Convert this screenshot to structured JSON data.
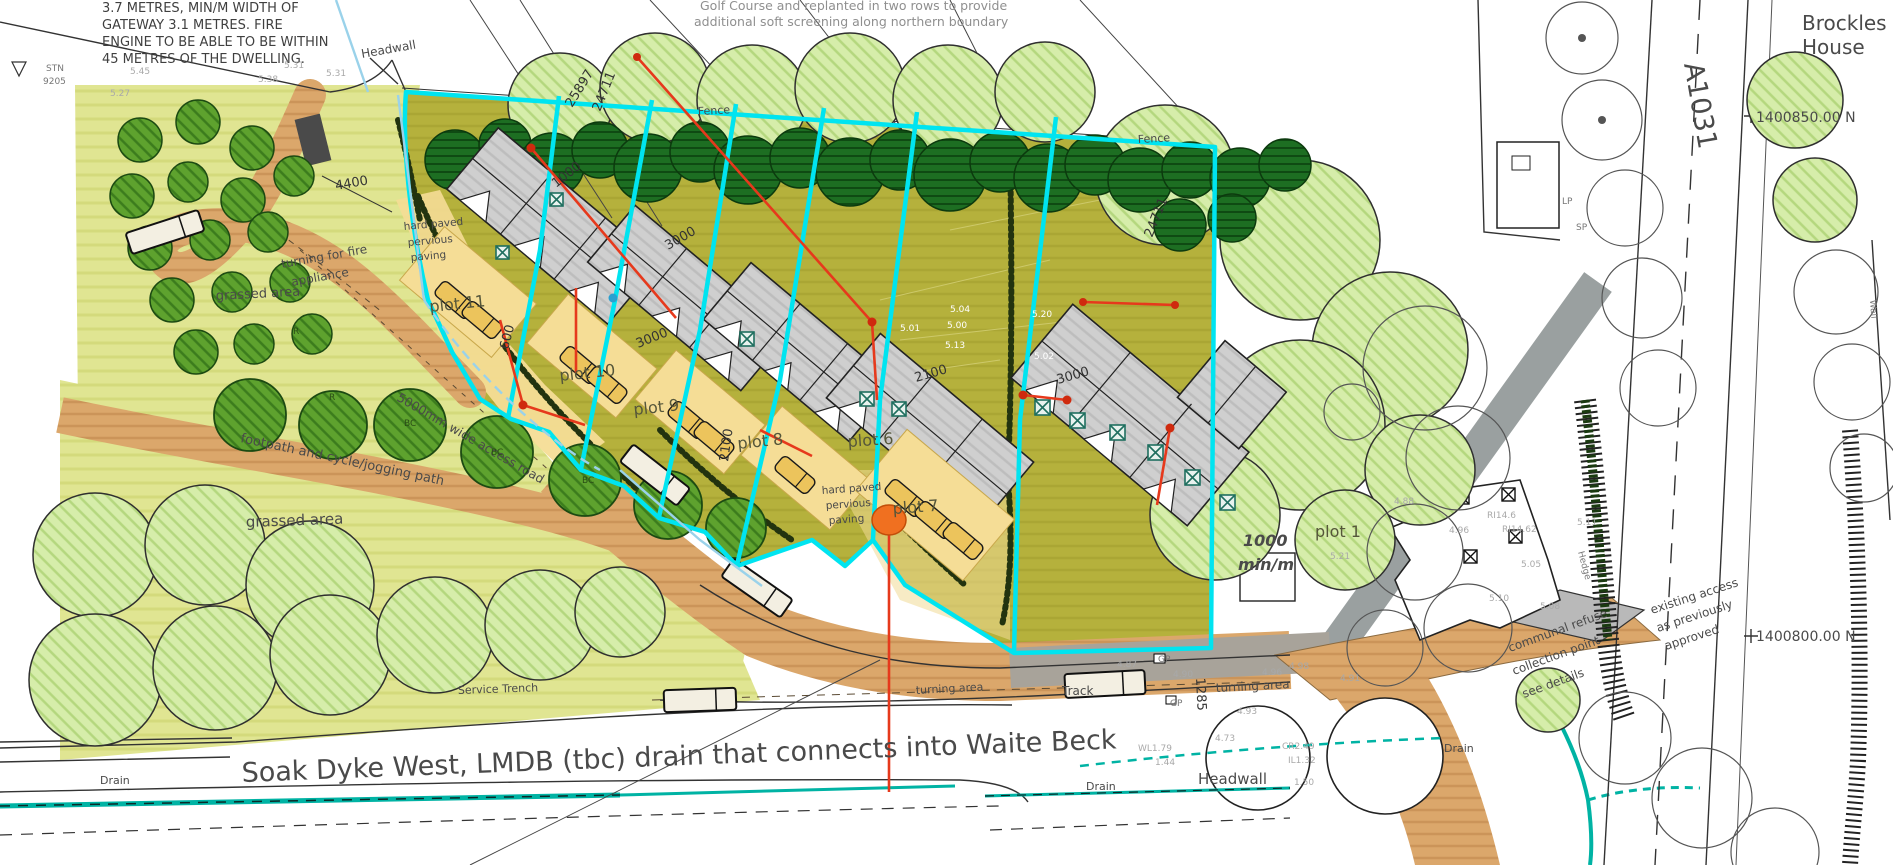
{
  "notes": {
    "fire_note": [
      "3.7 METRES, MIN/M WIDTH OF",
      "GATEWAY 3.1 METRES. FIRE",
      "ENGINE TO BE ABLE TO BE WITHIN",
      "45 METRES OF THE DWELLING."
    ],
    "golf_note": [
      "Golf Course and replanted in two rows to provide",
      "additional soft screening along northern boundary"
    ],
    "refuse_note": [
      "communal refuse",
      "collection point -",
      "see details"
    ],
    "access_note": [
      "existing access",
      "as previously",
      "approved"
    ]
  },
  "labels": {
    "headwall_top": "Headwall",
    "headwall_bottom": "Headwall",
    "stn": "STN",
    "stn_number": "9205",
    "brockles": [
      "Brockles",
      "House"
    ],
    "road_a1031": "A1031",
    "grid_ref_north": "1400850.00  N",
    "grid_ref_south": "1400800.00  N",
    "wall": "Wall",
    "hedge": "Hedge",
    "lp": "LP",
    "sp": "SP",
    "fence_west": "Fence",
    "fence_east": "Fence",
    "track": "Track",
    "gp_upper": "GP",
    "gp_lower": "GP",
    "turning_area_west": "turning area",
    "turning_area_east": "turning area",
    "service_trench": "Service Trench",
    "drains": [
      "Drain",
      "Drain",
      "Drain"
    ],
    "soak_dyke": "Soak Dyke West, LMDB (tbc) drain that connects into Waite Beck",
    "grassed_area_upper": "grassed area",
    "grassed_area_lower": "grassed area",
    "fire_turning": [
      "turning for fire",
      "appliance"
    ],
    "footpath": "footpath and cycle/jogging path",
    "access_width": "5000mm wide access road",
    "hard_paved_west": [
      "hard paved",
      "pervious",
      "paving"
    ],
    "hard_paved_east": [
      "hard paved",
      "pervious",
      "paving"
    ],
    "min_width": [
      "1000",
      "min/m"
    ]
  },
  "plots": {
    "p11": "plot 11",
    "p10": "plot 10",
    "p9": "plot 9",
    "p8": "plot 8",
    "p7": "plot 7",
    "p6": "plot 6",
    "p1": "plot 1"
  },
  "dimensions": {
    "d25897": "25897",
    "d24711_west": "24711",
    "d24711_east": "24711",
    "d4400": "4400",
    "d1000": "1000",
    "d3000_a": "3000",
    "d3000_b": "3000",
    "d600": "600",
    "d2100_a": "2100",
    "d2100_b": "2100",
    "d3000_c": "3000",
    "d1285": "1285"
  },
  "spot_levels": [
    "5.27",
    "5.45",
    "5.38",
    "5.31",
    "5.31",
    "5.04",
    "5.00",
    "5.01",
    "5.20",
    "5.13",
    "5.02",
    "4.88",
    "5.21",
    "4.96",
    "RI14.6",
    "RI14.62",
    "5.05",
    "5.11",
    "4.87",
    "4.90",
    "4.96",
    "4.93",
    "4.73",
    "WL1.79",
    "1.44",
    "CR2.49",
    "IL1.32",
    "1.50",
    "5.10",
    "5.08",
    "4.98",
    "4.91"
  ],
  "tree_codes": [
    "R",
    "R",
    "BC",
    "BC",
    "BC"
  ],
  "colors": {
    "plot_boundary_cyan": "#00e4f0",
    "drainage_red": "#e6391c",
    "drain_teal": "#00b3a4",
    "parcel_olive": "#b5b13c",
    "grass": "#e0e592",
    "path_brown": "#dba76b",
    "dark_tree": "#1d6e22",
    "pale_tree": "#d6edaa"
  }
}
